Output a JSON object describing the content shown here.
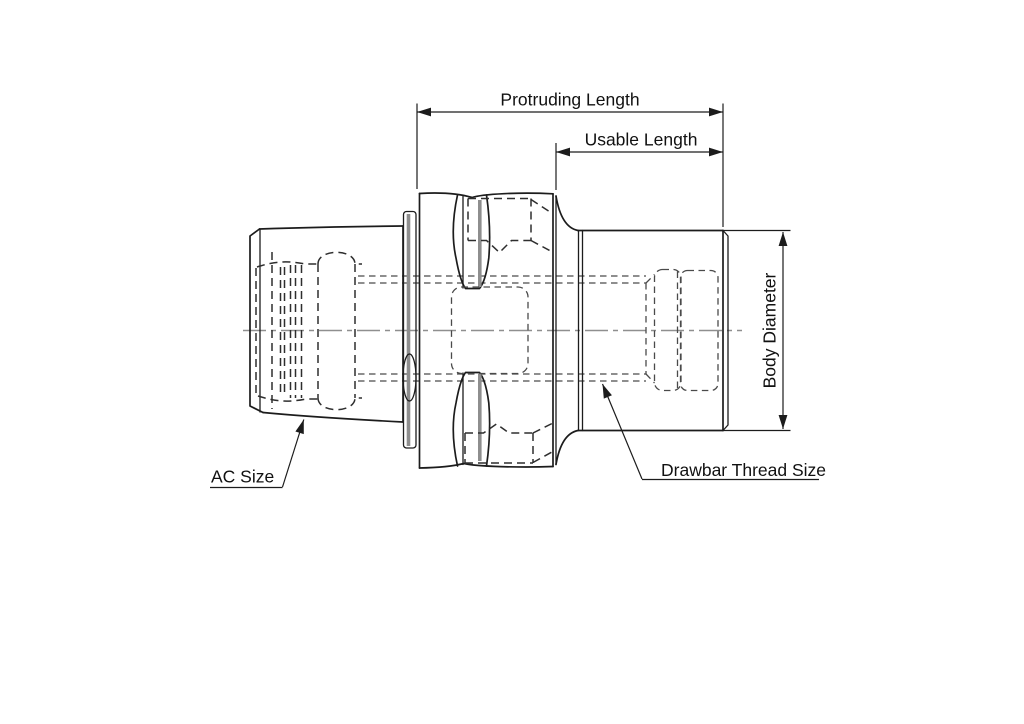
{
  "page": {
    "width": 1024,
    "height": 724,
    "background": "#ffffff"
  },
  "drawing": {
    "type": "engineering-drawing",
    "ink_color": "#1c1c1c",
    "hidden_line_color": "#2e2e2e",
    "centerline_color": "#8f8f8f",
    "accent_gray": "#8e8e8e",
    "labels": {
      "protruding_length": "Protruding Length",
      "usable_length": "Usable Length",
      "body_diameter": "Body Diameter",
      "ac_size": "AC Size",
      "drawbar_thread_size": "Drawbar Thread Size"
    }
  }
}
